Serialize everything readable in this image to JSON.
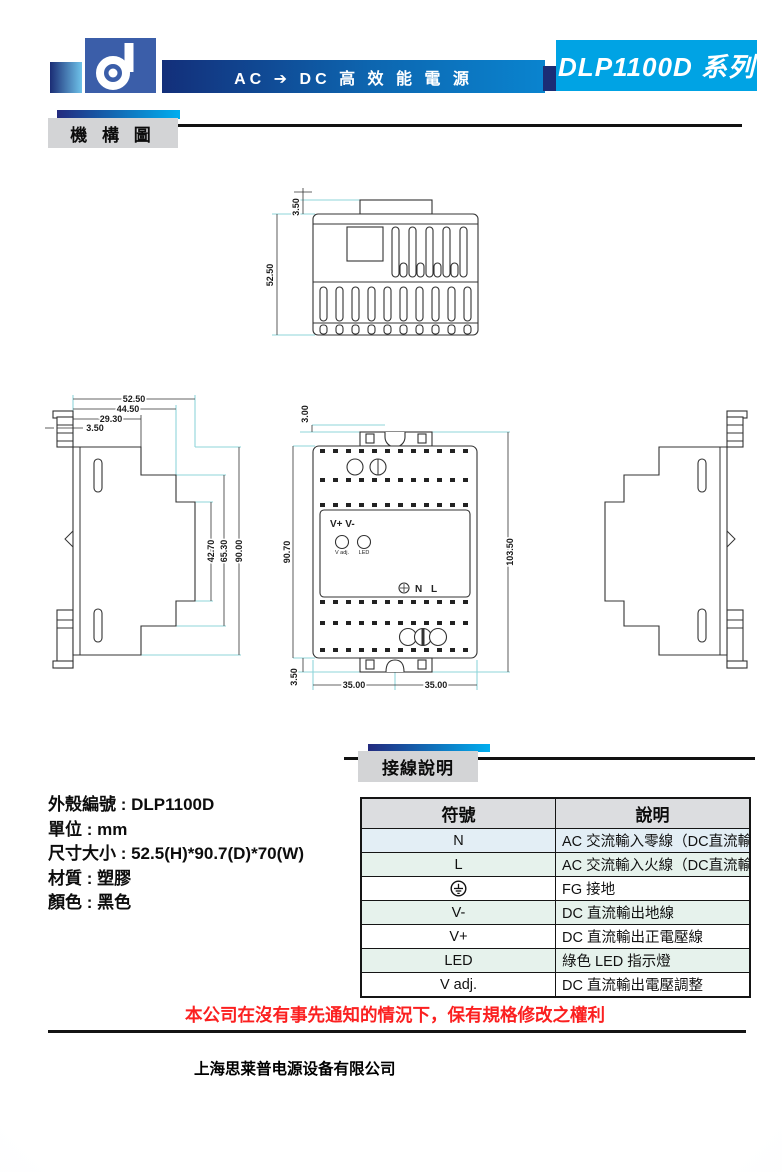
{
  "colors": {
    "accent_navy": "#132f7a",
    "accent_blue": "#0a84cf",
    "accent_cyan": "#00a3e4",
    "logo_blue": "#3b5ea9",
    "label_gray": "#d3d4d6",
    "table_header_gray": "#dcdde0",
    "row_tint_blue": "#e3eef5",
    "row_tint_green": "#e6f2ec",
    "warning_red": "#fb2020",
    "dim_line_cyan": "#8fd6da"
  },
  "icons": {
    "logo": "d-mark",
    "ground": "earth-ground",
    "input_ground": "circle-cross-screw"
  },
  "header": {
    "tagline": "AC ➔ DC 高 效 能 電 源",
    "series": "DLP1100D 系列"
  },
  "sections": {
    "mechanical": "機 構 圖",
    "wiring": "接線說明"
  },
  "specs": {
    "lines": [
      "外殼編號 : DLP1100D",
      "單位 : mm",
      "尺寸大小 : 52.5(H)*90.7(D)*70(W)",
      "材質 : 塑膠",
      "顏色 : 黑色"
    ]
  },
  "drawings": {
    "top_view": {
      "dims": {
        "tab_offset": "3.50",
        "depth": "52.50"
      }
    },
    "side_view": {
      "dims": {
        "w_full": "52.50",
        "w_mid": "44.50",
        "w_top": "29.30",
        "w_clip": "3.50",
        "h_mid": "42.70",
        "h_front": "65.30",
        "h_full": "90.00"
      }
    },
    "front_view": {
      "dims": {
        "tab": "3.00",
        "body_height": "90.70",
        "total_height": "103.50",
        "bottom_tab": "3.50",
        "w_left": "35.00",
        "w_right": "35.00"
      },
      "labels": {
        "output": "V+ V-",
        "vadj": "V adj.",
        "led": "LED",
        "input": "N L"
      }
    }
  },
  "table": {
    "headers": [
      "符號",
      "說明"
    ],
    "rows": [
      {
        "symbol": "N",
        "desc": "AC 交流輸入零線（DC直流輸入時無極性）"
      },
      {
        "symbol": "L",
        "desc": "AC 交流輸入火線（DC直流輸入時無極性）"
      },
      {
        "symbol": "",
        "desc": "FG 接地"
      },
      {
        "symbol": "V-",
        "desc": "DC 直流輸出地線"
      },
      {
        "symbol": "V+",
        "desc": "DC 直流輸出正電壓線"
      },
      {
        "symbol": "LED",
        "desc": "綠色 LED 指示燈"
      },
      {
        "symbol": "V adj.",
        "desc": "DC 直流輸出電壓調整"
      }
    ]
  },
  "disclaimer": "本公司在沒有事先通知的情況下，保有規格修改之權利",
  "footer": {
    "company": "上海思莱普电源设备有限公司"
  }
}
